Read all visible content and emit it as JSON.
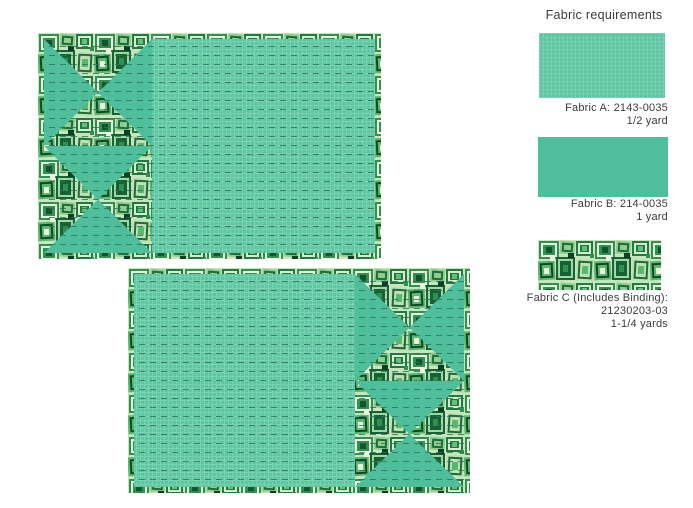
{
  "sidebar": {
    "title": "Fabric requirements",
    "fabrics": [
      {
        "id": "A",
        "swatch": "fabric-a-textured-green",
        "lines": [
          "Fabric A: 2143-0035",
          "1/2 yard"
        ]
      },
      {
        "id": "B",
        "swatch": "fabric-b-solid-green",
        "lines": [
          "Fabric B: 214-0035",
          "1 yard"
        ]
      },
      {
        "id": "C",
        "swatch": "fabric-c-squares-print",
        "lines": [
          "Fabric C (Includes Binding):",
          "21230203-03",
          "1-1/4 yards"
        ]
      }
    ]
  },
  "diagrams": [
    {
      "name": "placemat-top",
      "description": "Placemat mockup: hourglass-triangle column of Fabric C on left over Fabric B, large Fabric A panel on right, Fabric C binding border, horizontal dashed quilting lines"
    },
    {
      "name": "placemat-bottom",
      "description": "Placemat mockup mirrored: large Fabric A panel on left, hourglass-triangle column of Fabric C on right over Fabric B, Fabric C binding border, horizontal dashed quilting lines"
    }
  ],
  "colors": {
    "background": "#ffffff",
    "fabric_b_solid": "#4fbe9b",
    "fabric_a_base": "#5ec7a2",
    "print_dark_green": "#14532c",
    "print_mid_green": "#2e9152",
    "print_light_cream": "#ecf4de",
    "quilting_dash": "#2a6f5d",
    "text": "#3d3d3d"
  }
}
